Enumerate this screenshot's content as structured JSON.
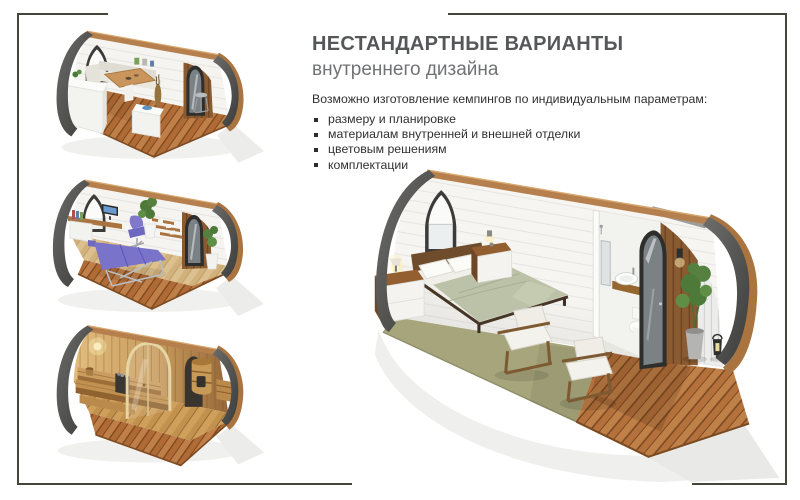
{
  "header": {
    "title": "НЕСТАНДАРТНЫЕ ВАРИАНТЫ",
    "subtitle": "внутреннего дизайна"
  },
  "body": {
    "intro": "Возможно изготовление кемпингов по индивидуальным параметрам:",
    "bullets": [
      "размеру и планировке",
      "материалам внутренней и внешней отделки",
      "цветовым решениям",
      "комплектации"
    ]
  },
  "figures": [
    {
      "id": "kitchen-pod-render"
    },
    {
      "id": "office-pod-render"
    },
    {
      "id": "sauna-pod-render"
    },
    {
      "id": "bedroom-pod-render"
    }
  ],
  "palette": {
    "frame_border": "#45453a",
    "title_text": "#565759",
    "subtitle_text": "#717274",
    "body_text": "#303030",
    "pod_shell_dark": "#4a4a48",
    "wood_deck": "#b06a35",
    "wood_trim": "#a9743f",
    "carpet_sage": "#a6a57c",
    "bedding_sage": "#bcc2a8",
    "accent_purple": "#7a73ca",
    "sauna_wood": "#d6ab6c"
  }
}
